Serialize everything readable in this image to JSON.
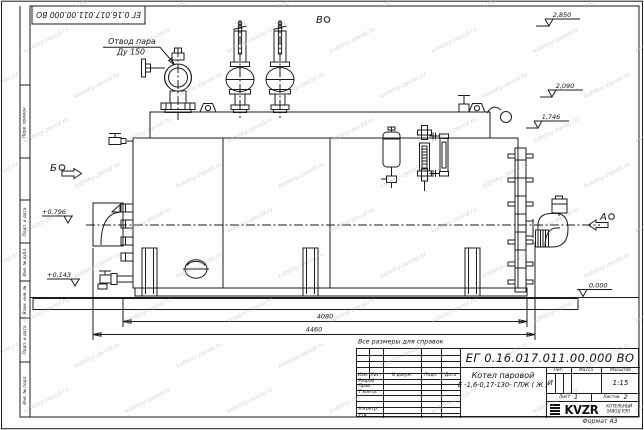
{
  "watermark": {
    "text": "kotelny-zavod.ru",
    "color": "#a9b6c6"
  },
  "frame": {
    "doc_number_top": "ЕГ 0.16.017.011.00.000  ВО",
    "format_note": "Формат А3",
    "side_labels": [
      "Перв. примен.",
      "Подп. и дата",
      "Инв. № дубл.",
      "Взам. инв. №",
      "Подп. и дата",
      "Инв. № подл."
    ]
  },
  "drawing": {
    "callouts": {
      "steam_outlet_line1": "Отвод пара",
      "steam_outlet_line2": "Ду 150"
    },
    "view_labels": {
      "a": "А",
      "b": "Б",
      "v": "В"
    },
    "elevations": {
      "valve_top": "2,850",
      "drum_top": "2,090",
      "casing_top": "1,746",
      "left_upper": "+0,796",
      "left_lower": "+0,143",
      "ground": "0,000"
    },
    "dimensions": {
      "base_length": "4080",
      "overall_length": "4460"
    },
    "note": "Все размеры для справок"
  },
  "title_block": {
    "doc_number": "ЕГ 0.16.017.011.00.000  ВО",
    "product_name": "Котел паровой",
    "product_designation": "Е -1,6-0,17-130- ГЛЖ ( Ж )",
    "header_cols": [
      "Изм.",
      "Лист",
      "N докум.",
      "Подп.",
      "Дата"
    ],
    "row_labels": [
      "Разраб.",
      "Пров.",
      "Т.контр.",
      "Н.контр.",
      "Утв."
    ],
    "lit_label": "Лит.",
    "lit_value": "И",
    "mass_label": "Масса",
    "scale_label": "Масштаб",
    "scale_value": "1:15",
    "sheet_label": "Лист",
    "sheet_value": "1",
    "sheets_label": "Листов",
    "sheets_value": "2",
    "logo_text": "KVZR",
    "company_line1": "КОТЕЛЬНЫЙ",
    "company_line2": "ЗАВОД РЭП"
  }
}
